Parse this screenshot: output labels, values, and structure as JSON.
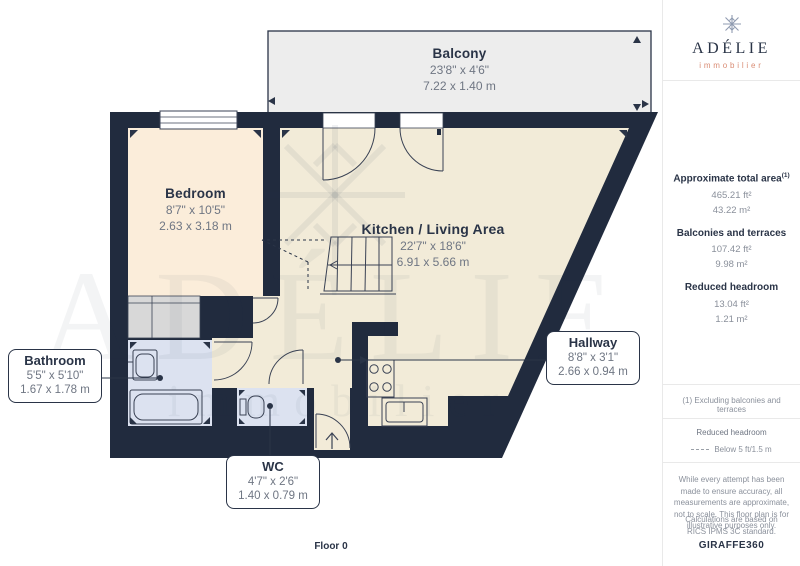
{
  "branding": {
    "name": "ADÉLIE",
    "subtitle": "immobilier",
    "footer_brand": "GIRAFFE",
    "footer_brand_suffix": "360"
  },
  "sidebar": {
    "total_area_label": "Approximate total area",
    "total_area_footnote_ref": "(1)",
    "total_area_ft": "465.21 ft²",
    "total_area_m": "43.22 m²",
    "balconies_label": "Balconies and terraces",
    "balconies_ft": "107.42 ft²",
    "balconies_m": "9.98 m²",
    "headroom_label": "Reduced headroom",
    "headroom_ft": "13.04 ft²",
    "headroom_m": "1.21 m²",
    "footnote": "(1) Excluding balconies and terraces",
    "legend_title": "Reduced headroom",
    "legend_item": "Below 5 ft/1.5 m",
    "disclaimer": "While every attempt has been made to ensure accuracy, all measurements are approximate, not to scale. This floor plan is for illustrative purposes only.",
    "standard_note": "Calculations are based on RICS IPMS 3C standard."
  },
  "plan": {
    "floor_label": "Floor 0",
    "watermark_text": "ADÉLIE",
    "watermark_subtext": "immobilier",
    "rooms": [
      {
        "name": "Balcony",
        "imperial": "23'8\" x 4'6\"",
        "metric": "7.22 x 1.40 m"
      },
      {
        "name": "Bedroom",
        "imperial": "8'7\" x 10'5\"",
        "metric": "2.63 x 3.18 m"
      },
      {
        "name": "Kitchen / Living Area",
        "imperial": "22'7\" x 18'6\"",
        "metric": "6.91 x 5.66 m"
      },
      {
        "name": "Hallway",
        "imperial": "8'8\" x 3'1\"",
        "metric": "2.66 x 0.94 m"
      },
      {
        "name": "Bathroom",
        "imperial": "5'5\" x 5'10\"",
        "metric": "1.67 x 1.78 m"
      },
      {
        "name": "WC",
        "imperial": "4'7\" x 2'6\"",
        "metric": "1.40 x 0.79 m"
      }
    ]
  },
  "colors": {
    "wall_navy": "#212B3E",
    "floor_beige": "#F2EBD8",
    "bedroom_peach": "#FBEDDA",
    "wet_room_blue": "#DCE2F0",
    "balcony_grey": "#EDEDED",
    "wardrobe_grey": "#D8D8D8",
    "accent_coral": "#D98C74",
    "label_navy": "#2A3447",
    "dim_grey": "#6F7683"
  }
}
